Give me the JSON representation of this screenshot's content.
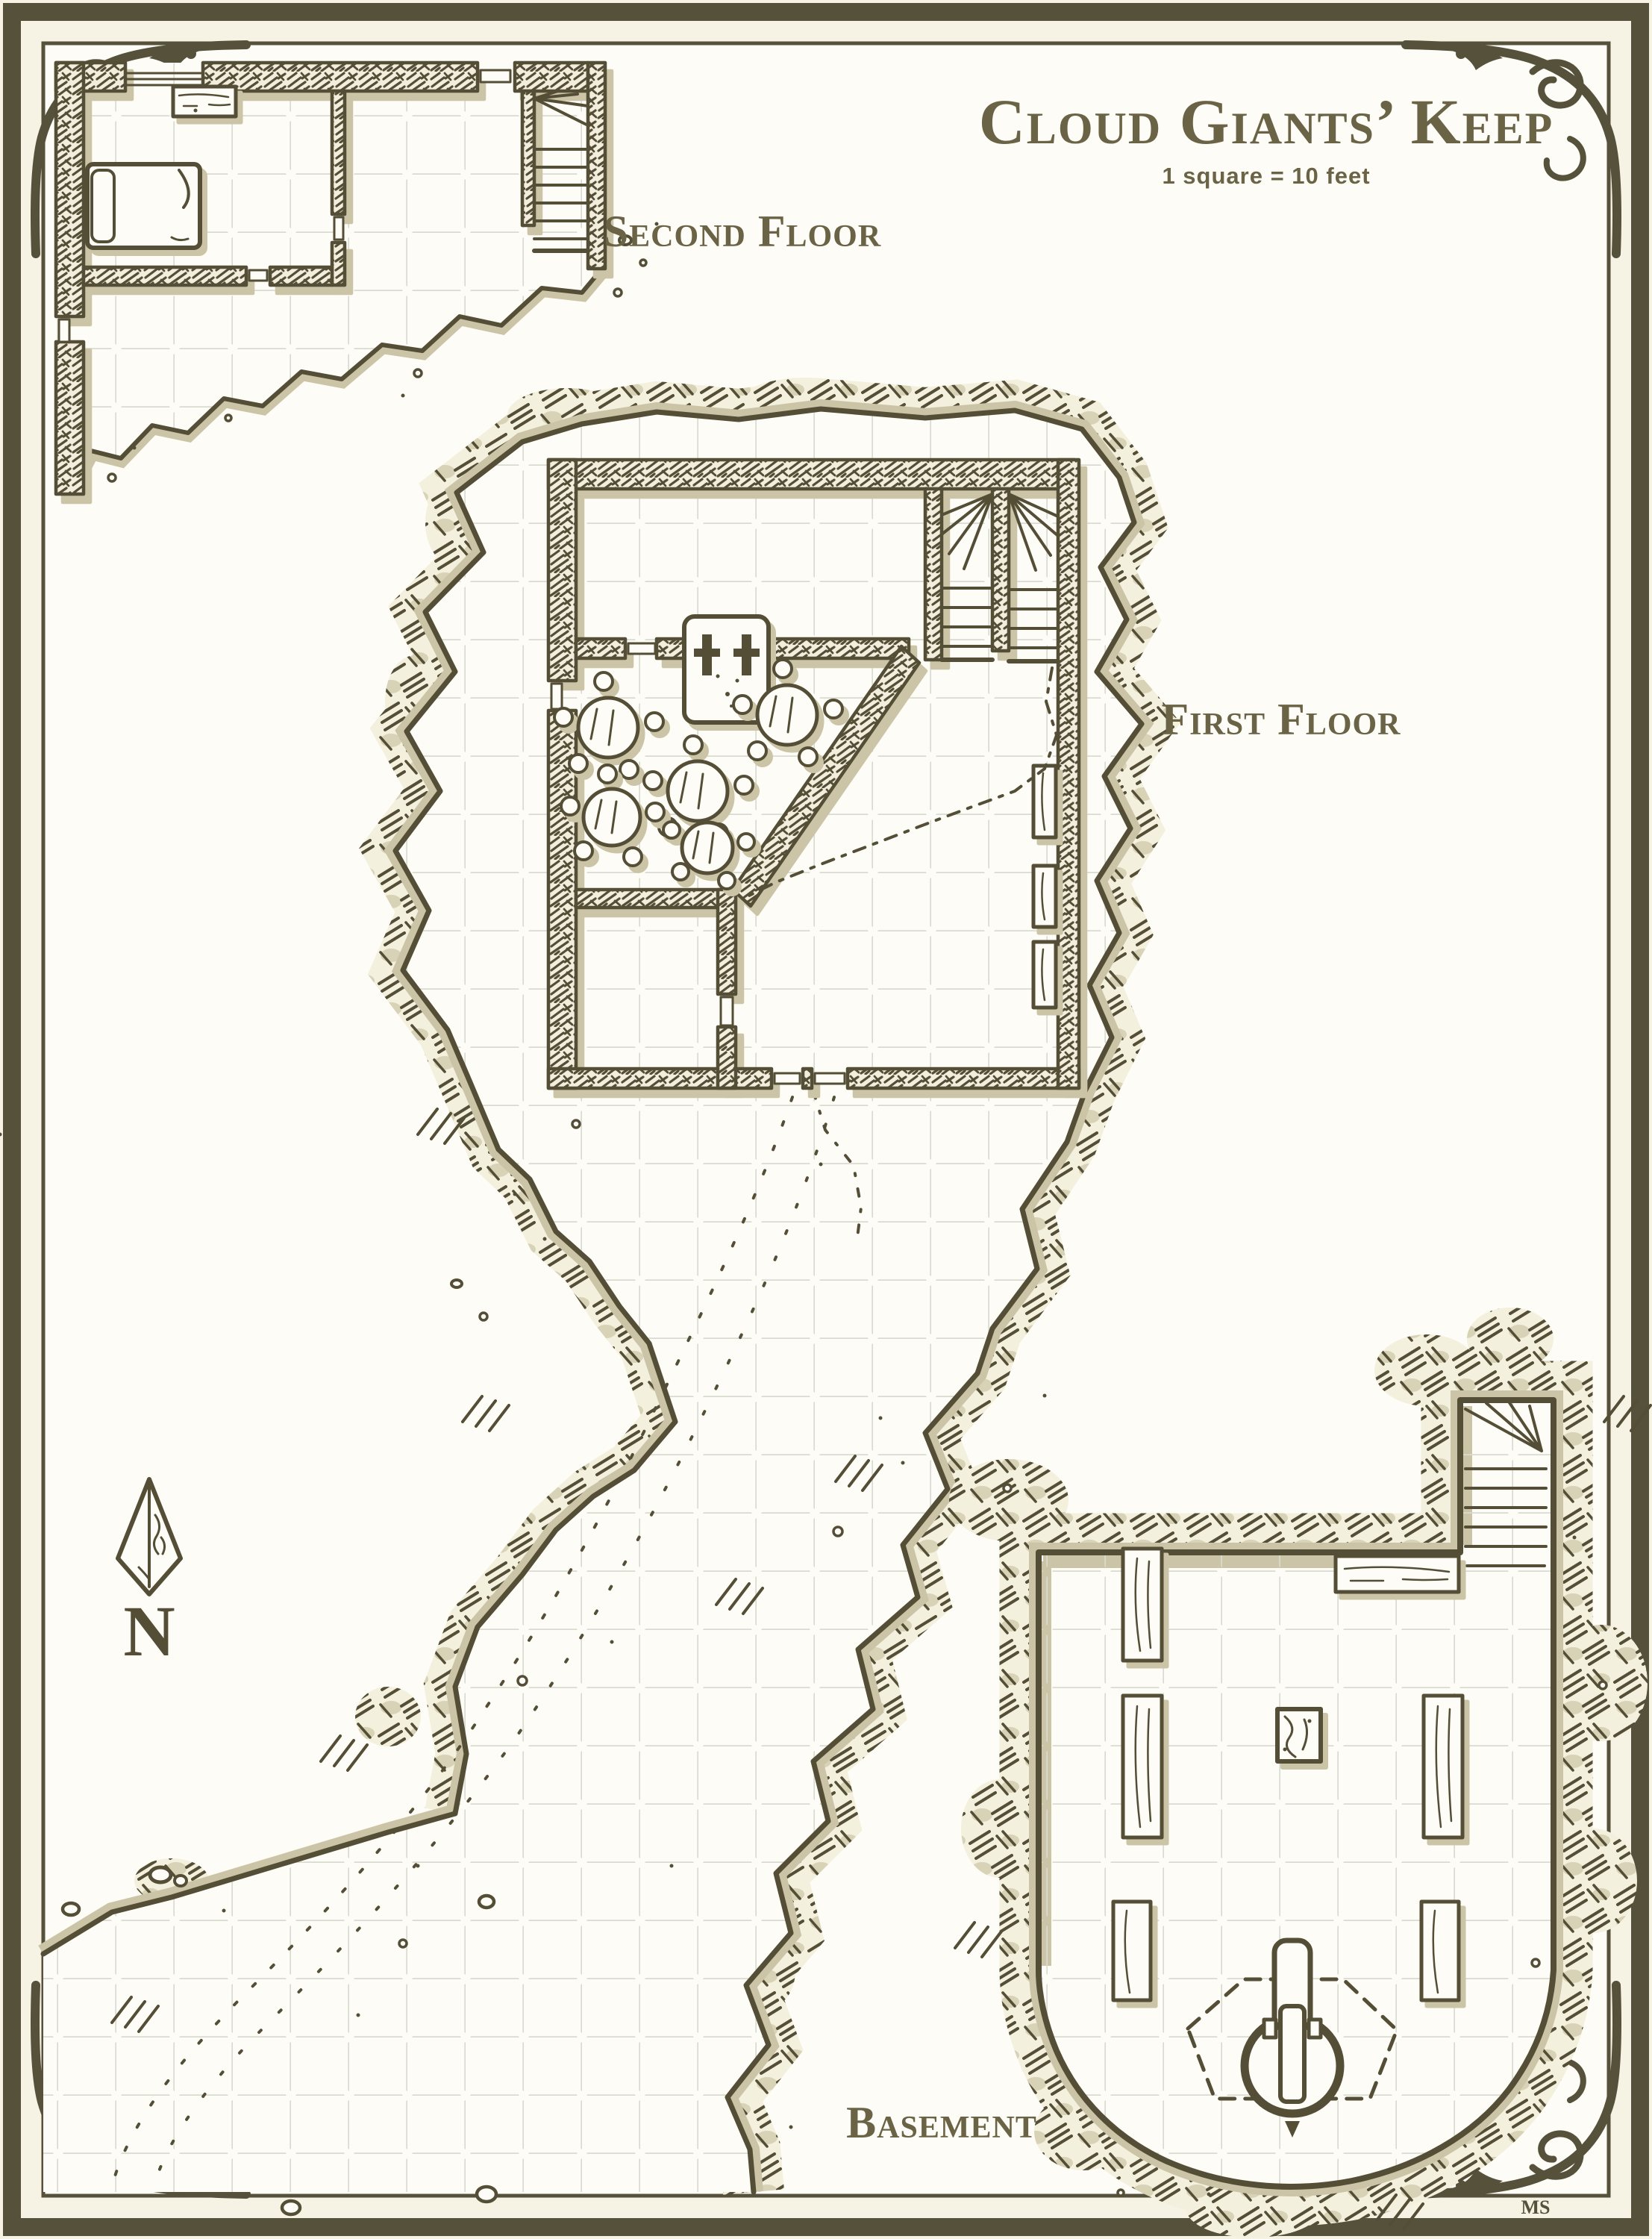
{
  "title": {
    "text": "Cloud Giants’ Keep",
    "scale_note": "1 square = 10 feet"
  },
  "floors": [
    {
      "id": "second-floor",
      "label": "Second Floor",
      "features": [
        "bed",
        "desk",
        "winder-staircase",
        "broken-terrace-edge"
      ]
    },
    {
      "id": "first-floor",
      "label": "First Floor",
      "features": [
        "twin-winder-staircases",
        "fireplace-with-andirons",
        "round-tables-with-stools",
        "storage-crates",
        "floor-crack",
        "cliff-terrace",
        "footpath-trail"
      ]
    },
    {
      "id": "basement",
      "label": "Basement",
      "features": [
        "cave-walls",
        "winder-staircase",
        "long-tables",
        "trapdoor",
        "well-winch"
      ]
    }
  ],
  "compass": {
    "label": "N",
    "icon": "arrowhead-north-icon"
  },
  "signature": {
    "text": "MS"
  },
  "colors": {
    "paper": "#fdfcf6",
    "cream": "#f6f2e4",
    "ink": "#554e36",
    "tan": "#cbc4a6",
    "grid": "#d9dbd0",
    "accent": "#6b6346",
    "band": "#56513a",
    "hatchbg": "#f2eddc",
    "rockbg": "#f4f0de",
    "rocktan": "#d8d2b6"
  }
}
